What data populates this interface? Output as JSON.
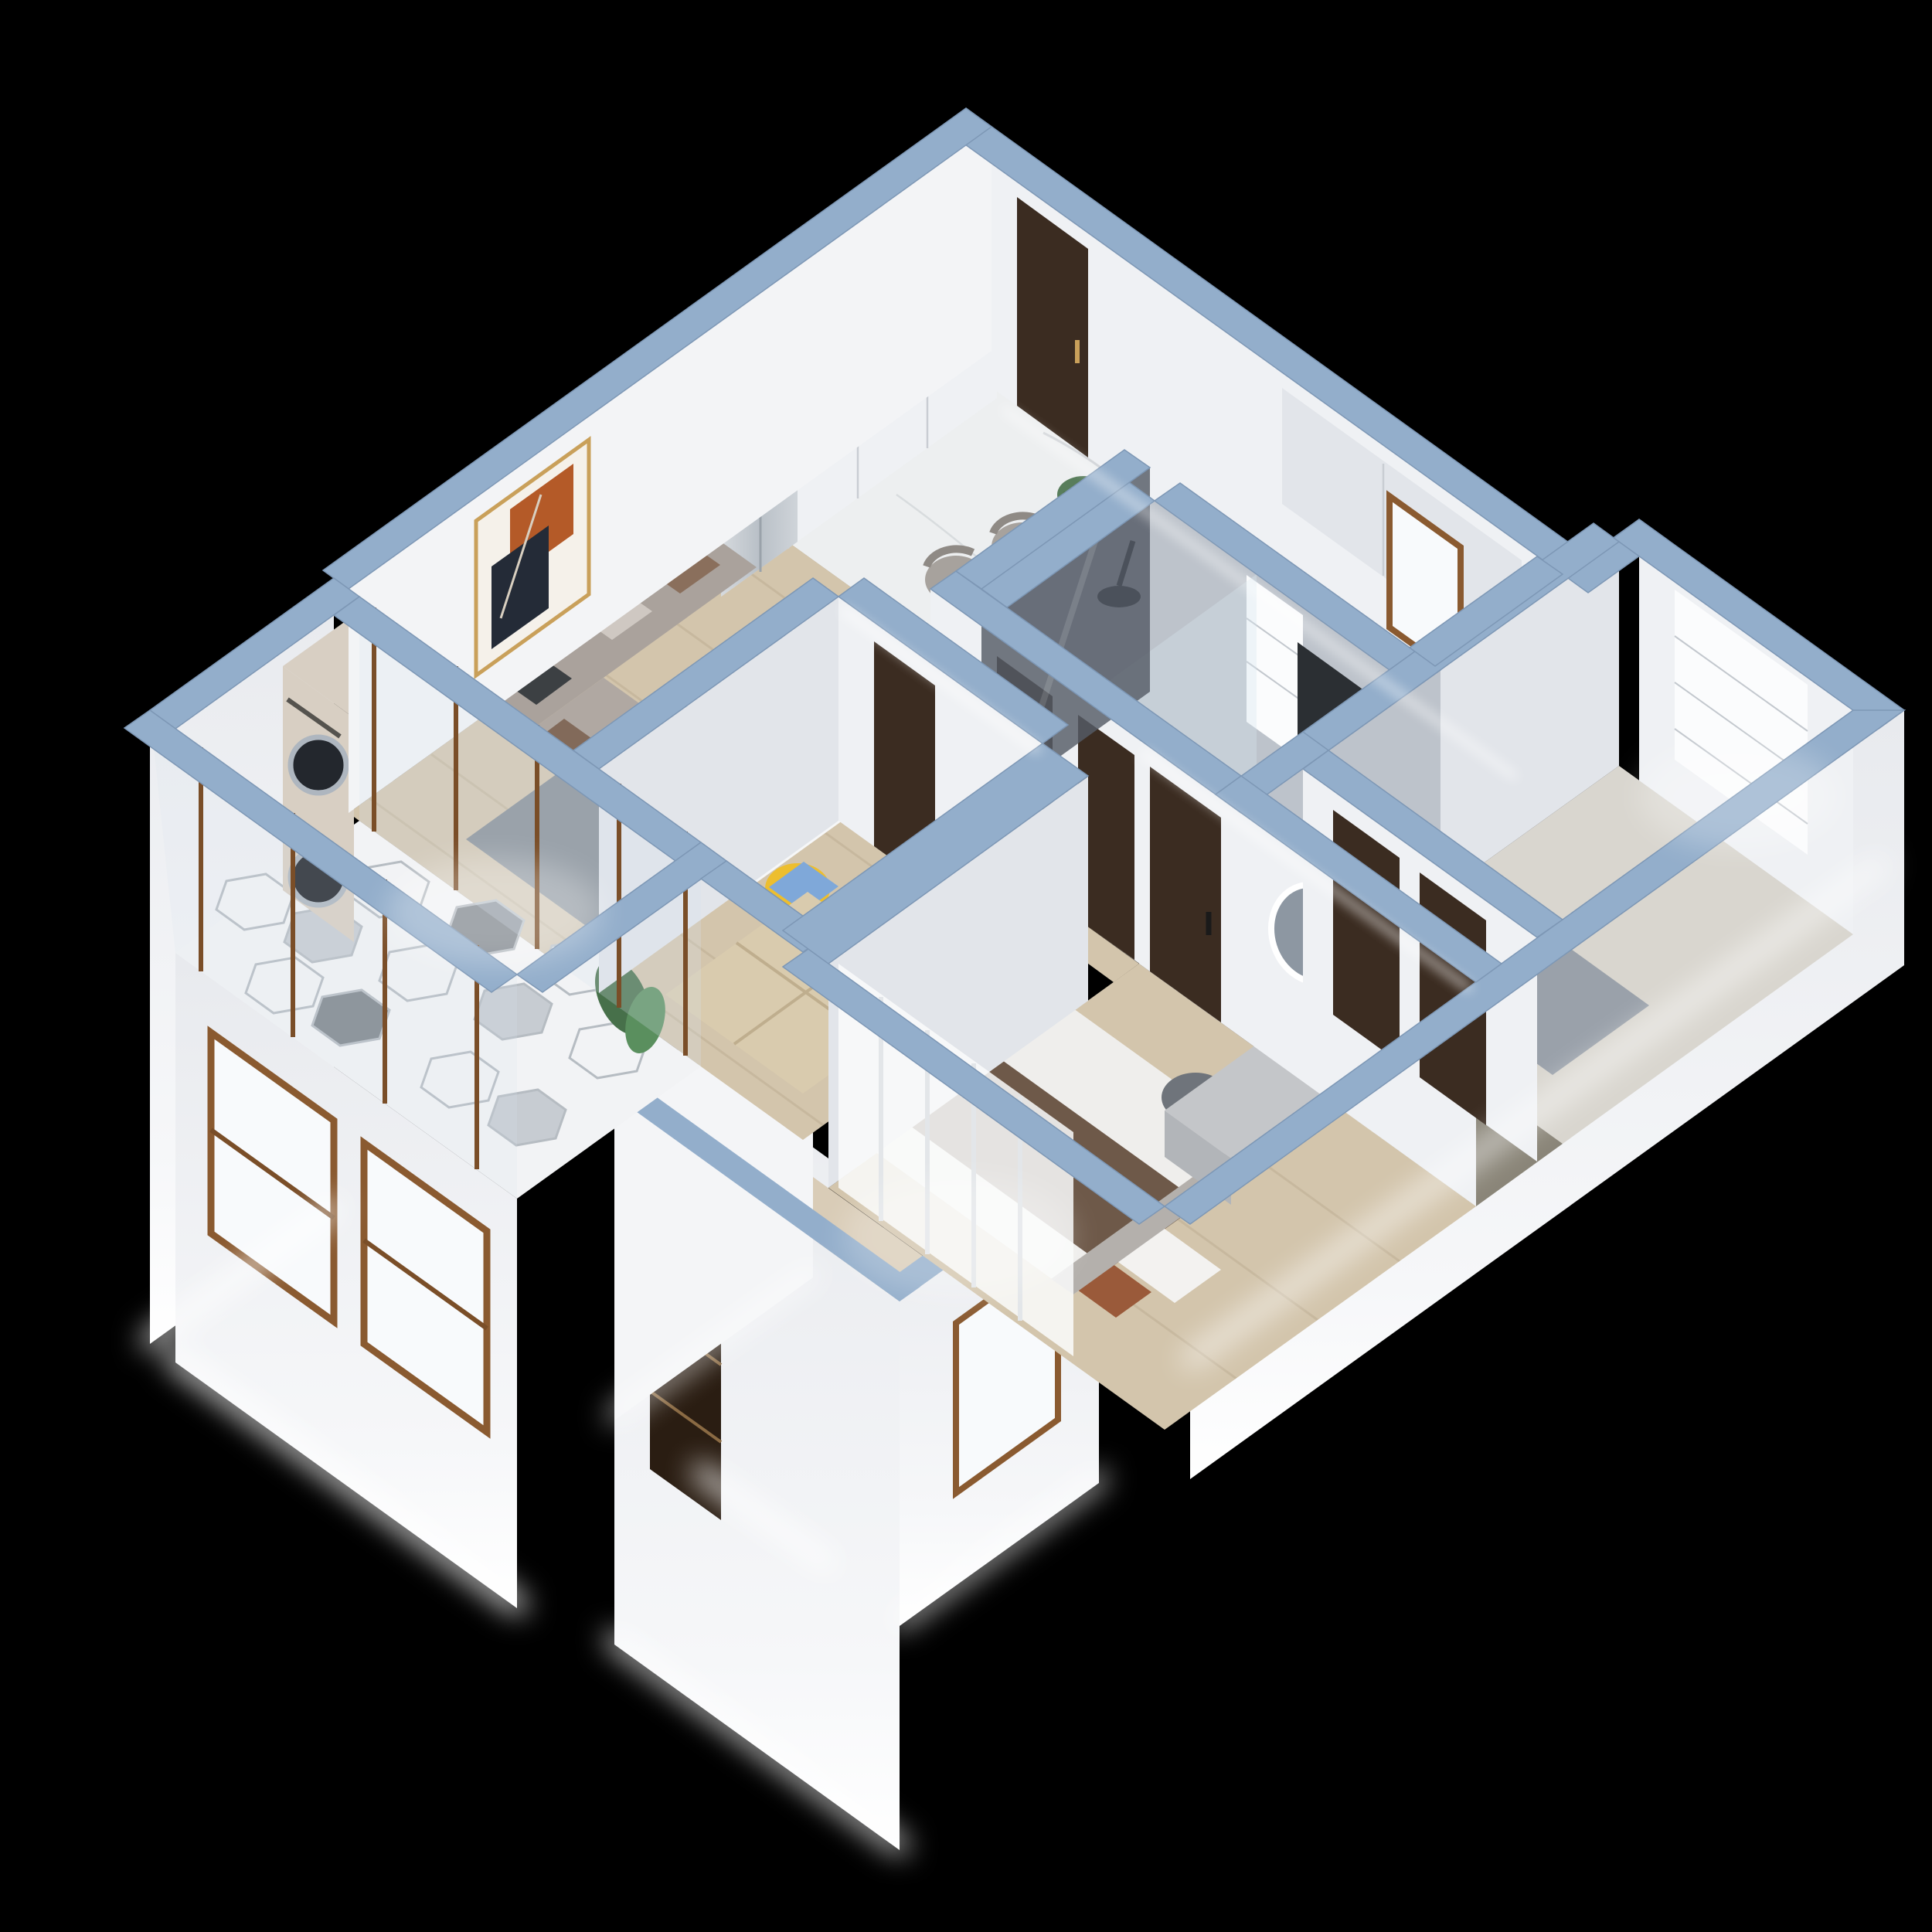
{
  "title": "3D isometric cutaway render of a two-bedroom apartment",
  "background": "#000000",
  "scene": {
    "view": "isometric-dollhouse-cutaway",
    "lighting": "white LED glow strips along exterior facade edges",
    "colors": {
      "backdrop": "#000000",
      "wall_top": "#93aecb",
      "wall_top_light": "#aec3d9",
      "wall_face": "#eff1f4",
      "wall_face_shade": "#e2e5ea",
      "exterior_wall": "#f4f5f7",
      "marble_floor": "#edeff0",
      "wood_floor": "#d3c5ac",
      "tatami_wood": "#d9cbae",
      "bathroom_wall": "#bdc3cb",
      "bathroom_floor": "#c7ccd3",
      "closet_floor": "#8a8578",
      "bedroom_floor": "#d9d6cf",
      "hex_white": "#f2f3f5",
      "hex_gray": "#c7ccd2",
      "hex_dark": "#7e858c",
      "door_dark": "#3b2c21",
      "window_frame": "#8a5a30",
      "glass": "#d7e4ee",
      "smoked_glass": "#565c66",
      "fridge": "#c6ccd2",
      "screen_dark": "#22262c",
      "counter_dark": "#4a4f55",
      "sofa": "#aaa29c",
      "rug": "#868c93",
      "art_orange": "#b45a28",
      "art_navy": "#242b37",
      "table_white": "#f6f7f8",
      "chair_gray": "#a7a29d",
      "chair_yellow": "#edbe2e",
      "pillow_blue": "#7fa8d9",
      "pillow_brown": "#8a6f5c",
      "bed_white": "#efeeec",
      "blanket_brown": "#6e5949",
      "pillow_rust": "#9a5a3a",
      "bed_gray": "#9aa1aa",
      "vanity_yellow": "#f0bb4d",
      "stool_gray": "#6f747b",
      "wardrobe_gray": "#c4c6c9",
      "washer_body": "#d8cfc3",
      "drum_dark": "#23272d",
      "plant_green": "#47704a",
      "curtain_white": "#fafbfc",
      "glow_white": "#ffffff",
      "balcony_tan": "#d9ccb7",
      "grille_dark": "#2a1d12",
      "tv_dark": "#15181c"
    },
    "rooms": [
      {
        "id": "entry",
        "label": "entry corridor",
        "items": [
          "dark-entry-door",
          "marble-floor",
          "wardrobe-cabinets"
        ]
      },
      {
        "id": "kitchen",
        "label": "kitchen",
        "items": [
          "gas-stove-2-burners",
          "upper-cabinets",
          "window",
          "smart-fridge-screen"
        ]
      },
      {
        "id": "living-dining",
        "label": "living and dining room",
        "items": [
          "gray-l-sofa",
          "abstract-artwork",
          "gray-rug",
          "coffee-table",
          "tv-console",
          "dining-table",
          "2-gray-chairs",
          "potted-plant"
        ]
      },
      {
        "id": "bathroom",
        "label": "bathroom",
        "items": [
          "black-shower-head",
          "glass-partition",
          "roller-blind-window",
          "dark-vanity-cabinets",
          "2-dark-doors"
        ]
      },
      {
        "id": "study",
        "label": "study bedroom",
        "items": [
          "white-desk",
          "laptop",
          "yellow-chair",
          "blue-pillow",
          "tatami-platform-bed",
          "wardrobe-shelves",
          "dark-door"
        ]
      },
      {
        "id": "bedroom-2",
        "label": "secondary bedroom",
        "items": [
          "white-roller-blind-window",
          "gray-bed"
        ]
      },
      {
        "id": "master-bedroom",
        "label": "master bedroom",
        "items": [
          "dark-door",
          "yellow-vanity",
          "led-round-mirror",
          "cosmetics",
          "gray-pouf",
          "double-bed-brown-blanket",
          "gray-wardrobe",
          "white-curtain"
        ]
      },
      {
        "id": "laundry-balcony",
        "label": "laundry balcony",
        "items": [
          "stacked-washer-dryer",
          "hexagon-tile-floor",
          "sliding-glass-doors",
          "green-plant",
          "facade-windows"
        ]
      },
      {
        "id": "rear-balcony",
        "label": "rear balcony",
        "items": [
          "white-walls",
          "brown-frame-window",
          "dark-grille-window"
        ]
      }
    ],
    "counts": {
      "stove_burners": 2,
      "washer_dryer_drums": 2,
      "facade_windows_front": 2,
      "balcony_sliding_panels": 4
    }
  }
}
